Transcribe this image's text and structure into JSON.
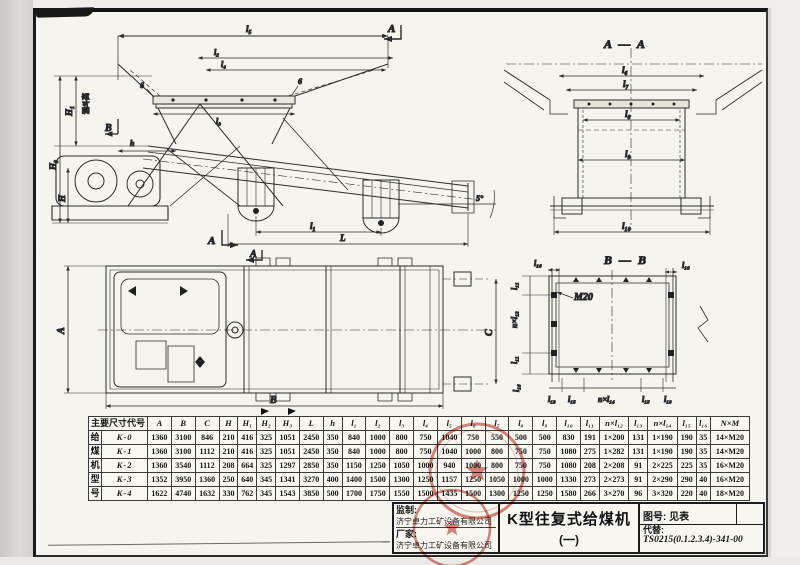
{
  "colors": {
    "ink": "#2b2b2b",
    "paper": "#f6f4ee",
    "seal_red": "#c03a2b"
  },
  "views": {
    "side": {
      "dim_l5": "l₅",
      "dim_l2": "l₂",
      "dim_l4": "l₄",
      "dim_l3": "l₃",
      "weld": "6",
      "section_a": "A",
      "section_b": "B",
      "dim_h": "h",
      "dim_H1": "H₁",
      "hopper_height_label": "漏斗高",
      "dim_H3": "H₃",
      "dim_H": "H",
      "dim_l1": "l₁",
      "dim_L": "L",
      "angle": "5°"
    },
    "aa": {
      "title": "A — A",
      "dims": [
        "l₆",
        "l₇",
        "l₈",
        "l₉",
        "l₁₀"
      ]
    },
    "plan": {
      "dim_A": "A",
      "dim_B": "B",
      "dim_C": "C",
      "section_a": "A"
    },
    "bb": {
      "title": "B — B",
      "bolt": "M20",
      "l16": "l₁₆",
      "l11": "l₁₁",
      "nxl12": "n×l₁₂",
      "l13": "l₁₃",
      "l15": "l₁₅",
      "nxl14": "n×l₁₄"
    }
  },
  "table": {
    "corner_header": "主要尺寸代号",
    "group_label": "给煤机型号",
    "group_chars": [
      "给",
      "煤",
      "机",
      "型",
      "号"
    ],
    "columns": [
      "A",
      "B",
      "C",
      "H",
      "H₁",
      "H₂",
      "H₃",
      "L",
      "h",
      "l₁",
      "l₂",
      "l₃",
      "l₄",
      "l₅",
      "l₆",
      "l₇",
      "l₈",
      "l₉",
      "l₁₀",
      "l₁₁",
      "n×l₁₂",
      "l₁₃",
      "n×l₁₄",
      "l₁₅",
      "l₁₆",
      "N×M"
    ],
    "rows": [
      {
        "code": "K-0",
        "values": [
          "1360",
          "3100",
          "846",
          "210",
          "416",
          "325",
          "1051",
          "2450",
          "350",
          "840",
          "1000",
          "800",
          "750",
          "1040",
          "750",
          "550",
          "500",
          "500",
          "830",
          "191",
          "1×200",
          "131",
          "1×190",
          "190",
          "35",
          "14×M20"
        ]
      },
      {
        "code": "K-1",
        "values": [
          "1360",
          "3100",
          "1112",
          "210",
          "416",
          "325",
          "1051",
          "2450",
          "350",
          "840",
          "1000",
          "800",
          "750",
          "1040",
          "1000",
          "800",
          "750",
          "750",
          "1080",
          "275",
          "1×282",
          "131",
          "1×190",
          "190",
          "35",
          "14×M20"
        ]
      },
      {
        "code": "K-2",
        "values": [
          "1360",
          "3540",
          "1112",
          "208",
          "664",
          "325",
          "1297",
          "2850",
          "350",
          "1150",
          "1250",
          "1050",
          "1000",
          "940",
          "1000",
          "800",
          "750",
          "750",
          "1080",
          "208",
          "2×208",
          "91",
          "2×225",
          "225",
          "35",
          "16×M20"
        ]
      },
      {
        "code": "K-3",
        "values": [
          "1352",
          "3950",
          "1360",
          "250",
          "640",
          "345",
          "1341",
          "3270",
          "400",
          "1400",
          "1500",
          "1300",
          "1250",
          "1157",
          "1250",
          "1050",
          "1000",
          "1000",
          "1330",
          "273",
          "2×273",
          "91",
          "2×290",
          "290",
          "40",
          "16×M20"
        ]
      },
      {
        "code": "K-4",
        "values": [
          "1622",
          "4740",
          "1632",
          "330",
          "762",
          "345",
          "1543",
          "3850",
          "500",
          "1700",
          "1750",
          "1550",
          "1500",
          "1435",
          "1500",
          "1300",
          "1250",
          "1250",
          "1580",
          "266",
          "3×270",
          "96",
          "3×320",
          "220",
          "40",
          "18×M20"
        ]
      }
    ]
  },
  "title_block": {
    "supervise_label": "监制:",
    "supervise_value": "济宁卓力工矿设备有限公司",
    "maker_label": "厂家:",
    "maker_value": "济宁卓力工矿设备有限公司",
    "title": "K型往复式给煤机",
    "subtitle": "(一)",
    "drawing_no": "图号: 见表",
    "replace_label": "代替:",
    "replace_value": "TS0215(0.1.2.3.4)-341-00"
  }
}
